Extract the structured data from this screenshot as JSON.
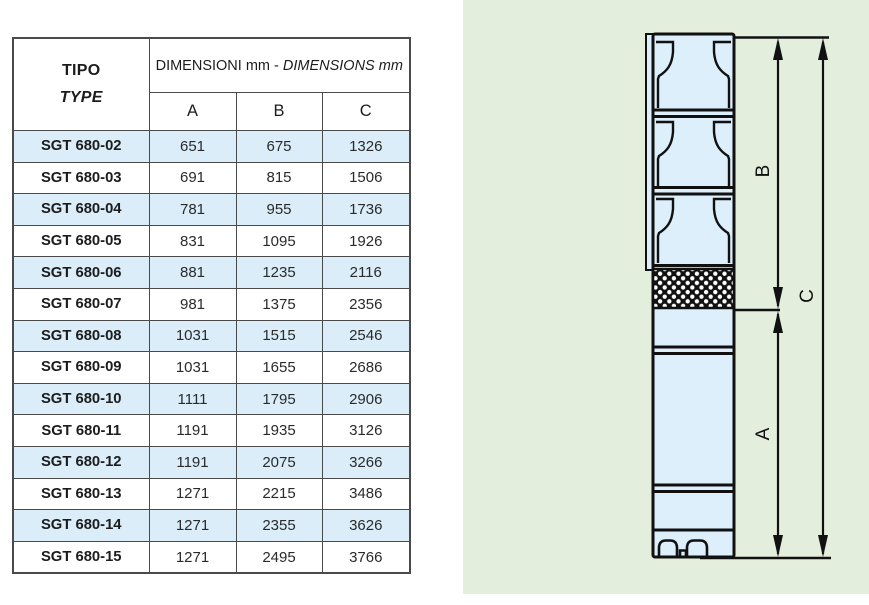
{
  "table": {
    "header": {
      "tipo": "TIPO",
      "type": "TYPE",
      "dimensions_it": "DIMENSIONI mm - ",
      "dimensions_en": "DIMENSIONS mm",
      "col_a": "A",
      "col_b": "B",
      "col_c": "C"
    },
    "rows": [
      {
        "type": "SGT 680-02",
        "a": "651",
        "b": "675",
        "c": "1326"
      },
      {
        "type": "SGT 680-03",
        "a": "691",
        "b": "815",
        "c": "1506"
      },
      {
        "type": "SGT 680-04",
        "a": "781",
        "b": "955",
        "c": "1736"
      },
      {
        "type": "SGT 680-05",
        "a": "831",
        "b": "1095",
        "c": "1926"
      },
      {
        "type": "SGT 680-06",
        "a": "881",
        "b": "1235",
        "c": "2116"
      },
      {
        "type": "SGT 680-07",
        "a": "981",
        "b": "1375",
        "c": "2356"
      },
      {
        "type": "SGT 680-08",
        "a": "1031",
        "b": "1515",
        "c": "2546"
      },
      {
        "type": "SGT 680-09",
        "a": "1031",
        "b": "1655",
        "c": "2686"
      },
      {
        "type": "SGT 680-10",
        "a": "1111",
        "b": "1795",
        "c": "2906"
      },
      {
        "type": "SGT 680-11",
        "a": "1191",
        "b": "1935",
        "c": "3126"
      },
      {
        "type": "SGT 680-12",
        "a": "1191",
        "b": "2075",
        "c": "3266"
      },
      {
        "type": "SGT 680-13",
        "a": "1271",
        "b": "2215",
        "c": "3486"
      },
      {
        "type": "SGT 680-14",
        "a": "1271",
        "b": "2355",
        "c": "3626"
      },
      {
        "type": "SGT 680-15",
        "a": "1271",
        "b": "2495",
        "c": "3766"
      }
    ]
  },
  "diagram": {
    "labels": {
      "a": "A",
      "b": "B",
      "c": "C"
    }
  },
  "colors": {
    "panel_green": "#e3efdc",
    "pump_fill": "#ddeffb",
    "row_highlight": "#daedf9",
    "line": "#111111",
    "table_border": "#4a4a4a"
  }
}
